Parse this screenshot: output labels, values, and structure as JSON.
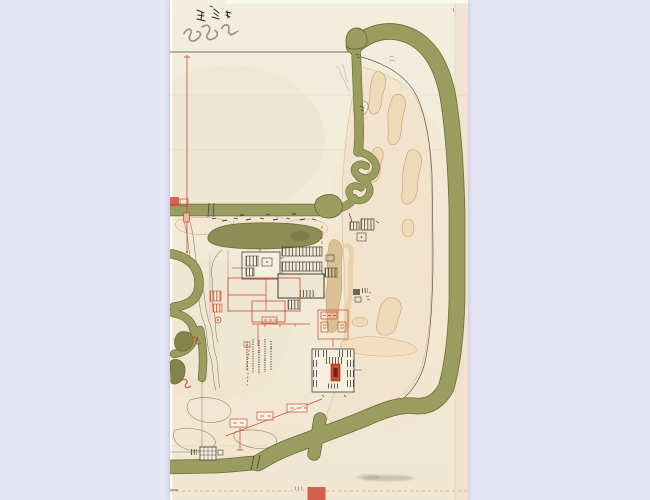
{
  "colors": {
    "viewer_bg": "#e4e6f3",
    "paper": "#f1ecda",
    "paper_edge_band": "#eedcc6",
    "moat_olive": "#9b9c60",
    "moat_outline": "#6b6c3b",
    "pond_olive": "#8e8d55",
    "ink_black": "#3f3e34",
    "ink_red": "#c64a32",
    "outline_brown": "#b09663",
    "pink_wash": "#f4e3cd",
    "tan_blob": "#f0d9b8",
    "stamp_red": "#d2604a"
  },
  "paper": {
    "page_number": "111"
  }
}
